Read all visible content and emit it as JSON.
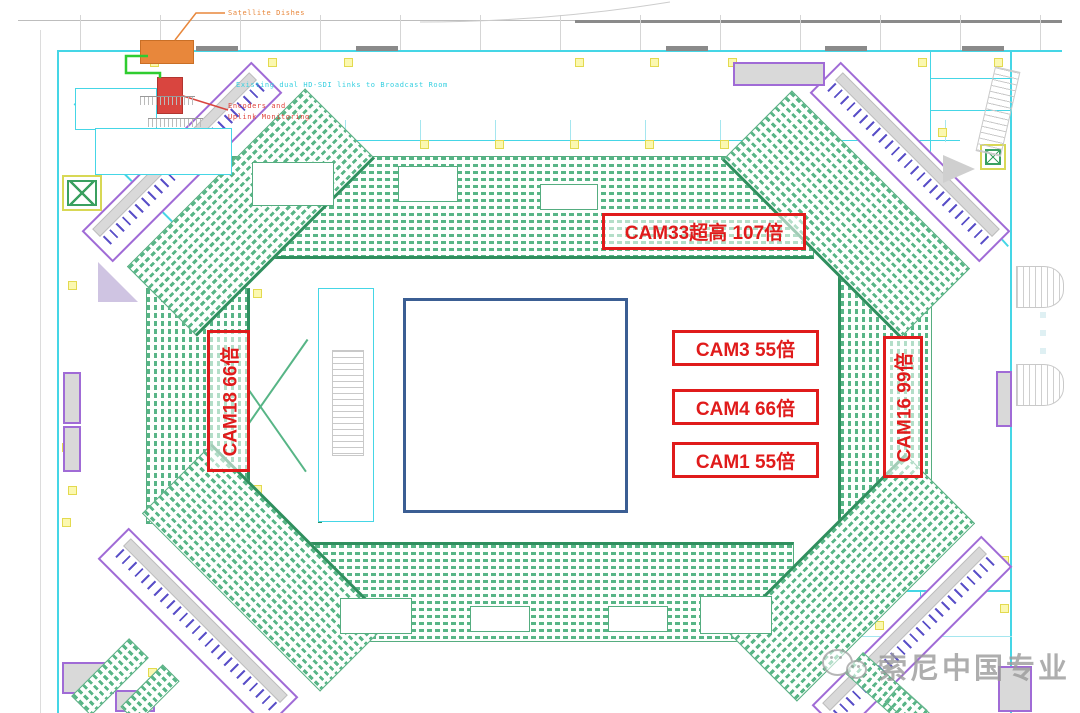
{
  "plan": {
    "title_hint": "Arena broadcast camera floor plan",
    "annotations": {
      "satellite_dishes": "Satellite Dishes",
      "hd_sdi_link": "Existing dual HD-SDI links to Broadcast Room",
      "encoders_line1": "Encoders and",
      "encoders_line2": "Uplink Monitoring"
    },
    "camera_labels": {
      "cam33": "CAM33超高 107倍",
      "cam3": "CAM3 55倍",
      "cam4": "CAM4 66倍",
      "cam1": "CAM1 55倍",
      "cam18": "CAM18 66倍",
      "cam16": "CAM16 99倍"
    },
    "watermark_text": "索尼中国专业",
    "colors": {
      "annotation_red": "#e01b1b",
      "satellite_orange": "#e8873b",
      "encoder_red": "#d9453f",
      "wall_cyan": "#45d6e6",
      "seat_green": "#57b586",
      "seat_dark_green": "#2f8f5e",
      "court_navy": "#3b5e93",
      "cable_green": "#2fcc2f",
      "room_purple": "#a06bd6",
      "column_yellow": "#fbf8b0",
      "watermark_gray": "#9a9a9a"
    }
  }
}
